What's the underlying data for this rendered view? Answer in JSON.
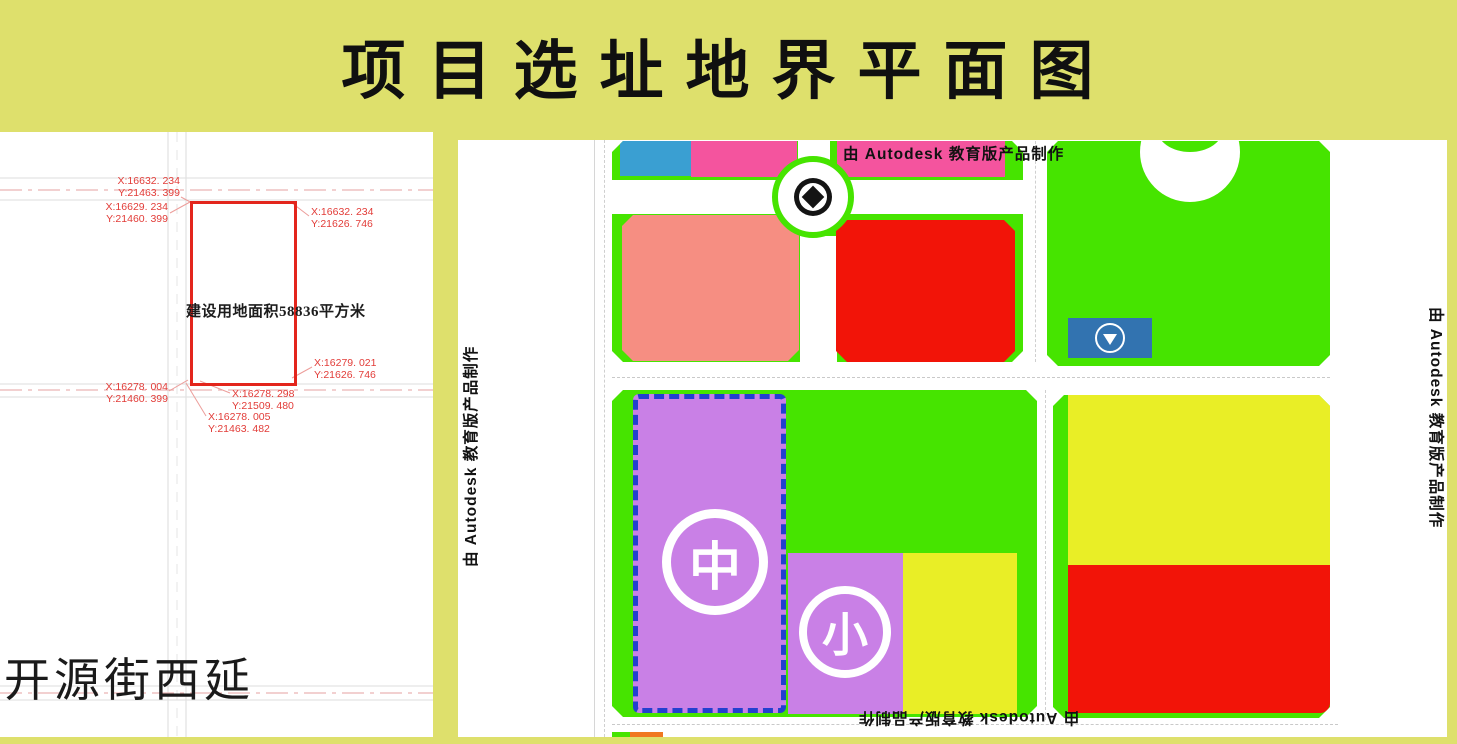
{
  "title": "项目选址地界平面图",
  "watermark": "由 Autodesk 教育版产品制作",
  "left_panel": {
    "street_name": "开源街西延",
    "area_text": "建设用地面积58836平方米",
    "coordinates": [
      {
        "x": "X:16632. 234",
        "y": "Y:21463. 399"
      },
      {
        "x": "X:16629. 234",
        "y": "Y:21460. 399"
      },
      {
        "x": "X:16632. 234",
        "y": "Y:21626. 746"
      },
      {
        "x": "X:16279. 021",
        "y": "Y:21626. 746"
      },
      {
        "x": "X:16278. 004",
        "y": "Y:21460. 399"
      },
      {
        "x": "X:16278. 298",
        "y": "Y:21509. 480"
      },
      {
        "x": "X:16278. 005",
        "y": "Y:21463. 482"
      }
    ]
  },
  "map_panel": {
    "middle_school_label": "中",
    "primary_school_label": "小",
    "colors": {
      "page_bg": "#dee06c",
      "green": "#46e400",
      "red": "#f21408",
      "yellow": "#e9ee26",
      "purple": "#c980e6",
      "salmon": "#f68e82",
      "pink": "#f4549e",
      "sky_blue": "#3a9fd2",
      "sign_blue": "#3273b0",
      "dash_border": "#2340cf",
      "orange": "#f07820",
      "coord_red": "#e23c38"
    }
  }
}
